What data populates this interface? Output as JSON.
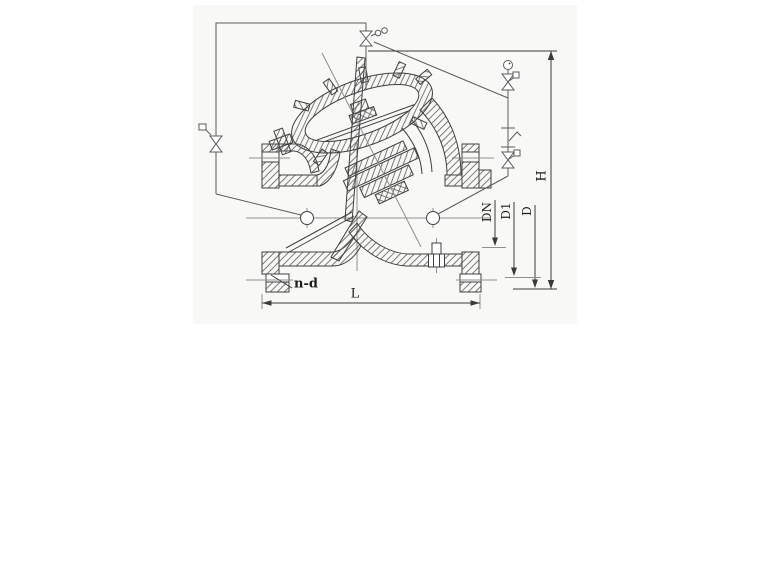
{
  "drawing": {
    "type": "technical-section-drawing",
    "subject": "diaphragm-actuated pump control valve with pilot piping",
    "labels": {
      "H": "H",
      "DN": "DN",
      "D1": "D1",
      "D": "D",
      "L": "L",
      "n_d": "n-d"
    },
    "colors": {
      "line": "#3f3f3f",
      "centerline": "#8f8f8f",
      "dimension": "#3a3a3a",
      "pipe": "#5c5c5c",
      "background": "#ffffff",
      "scan_area": "#f8f8f6",
      "text": "#1c1c1c"
    }
  }
}
